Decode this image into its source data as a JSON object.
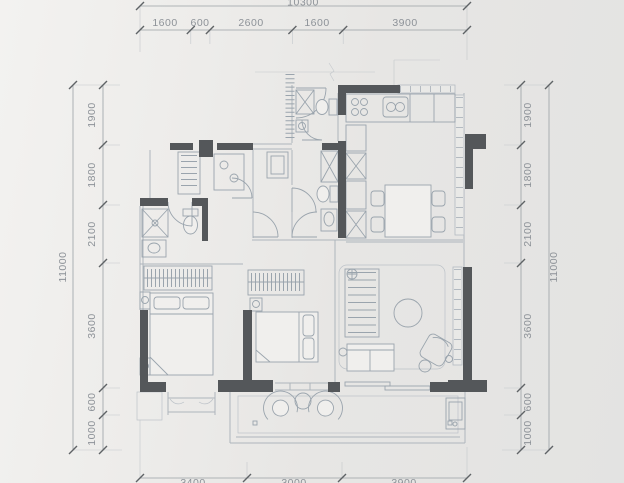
{
  "drawing": {
    "type": "apartment-floor-plan",
    "units": "mm"
  },
  "dimensions": {
    "top": {
      "total": "10300",
      "segments": [
        "1600",
        "600",
        "2600",
        "1600",
        "3900"
      ]
    },
    "left": {
      "total": "11000",
      "segments": [
        "1900",
        "1800",
        "2100",
        "3600",
        "600",
        "1000"
      ]
    },
    "right": {
      "total": "11000",
      "segments": [
        "1900",
        "1800",
        "2100",
        "3600",
        "600",
        "1000"
      ]
    },
    "bottom": {
      "segments": [
        "3400",
        "3000",
        "3900"
      ]
    }
  },
  "colors": {
    "wall": "#54575a",
    "drawing_line": "#aeb5bc",
    "dimension_text": "#8d9298",
    "background": "#eceae8"
  }
}
